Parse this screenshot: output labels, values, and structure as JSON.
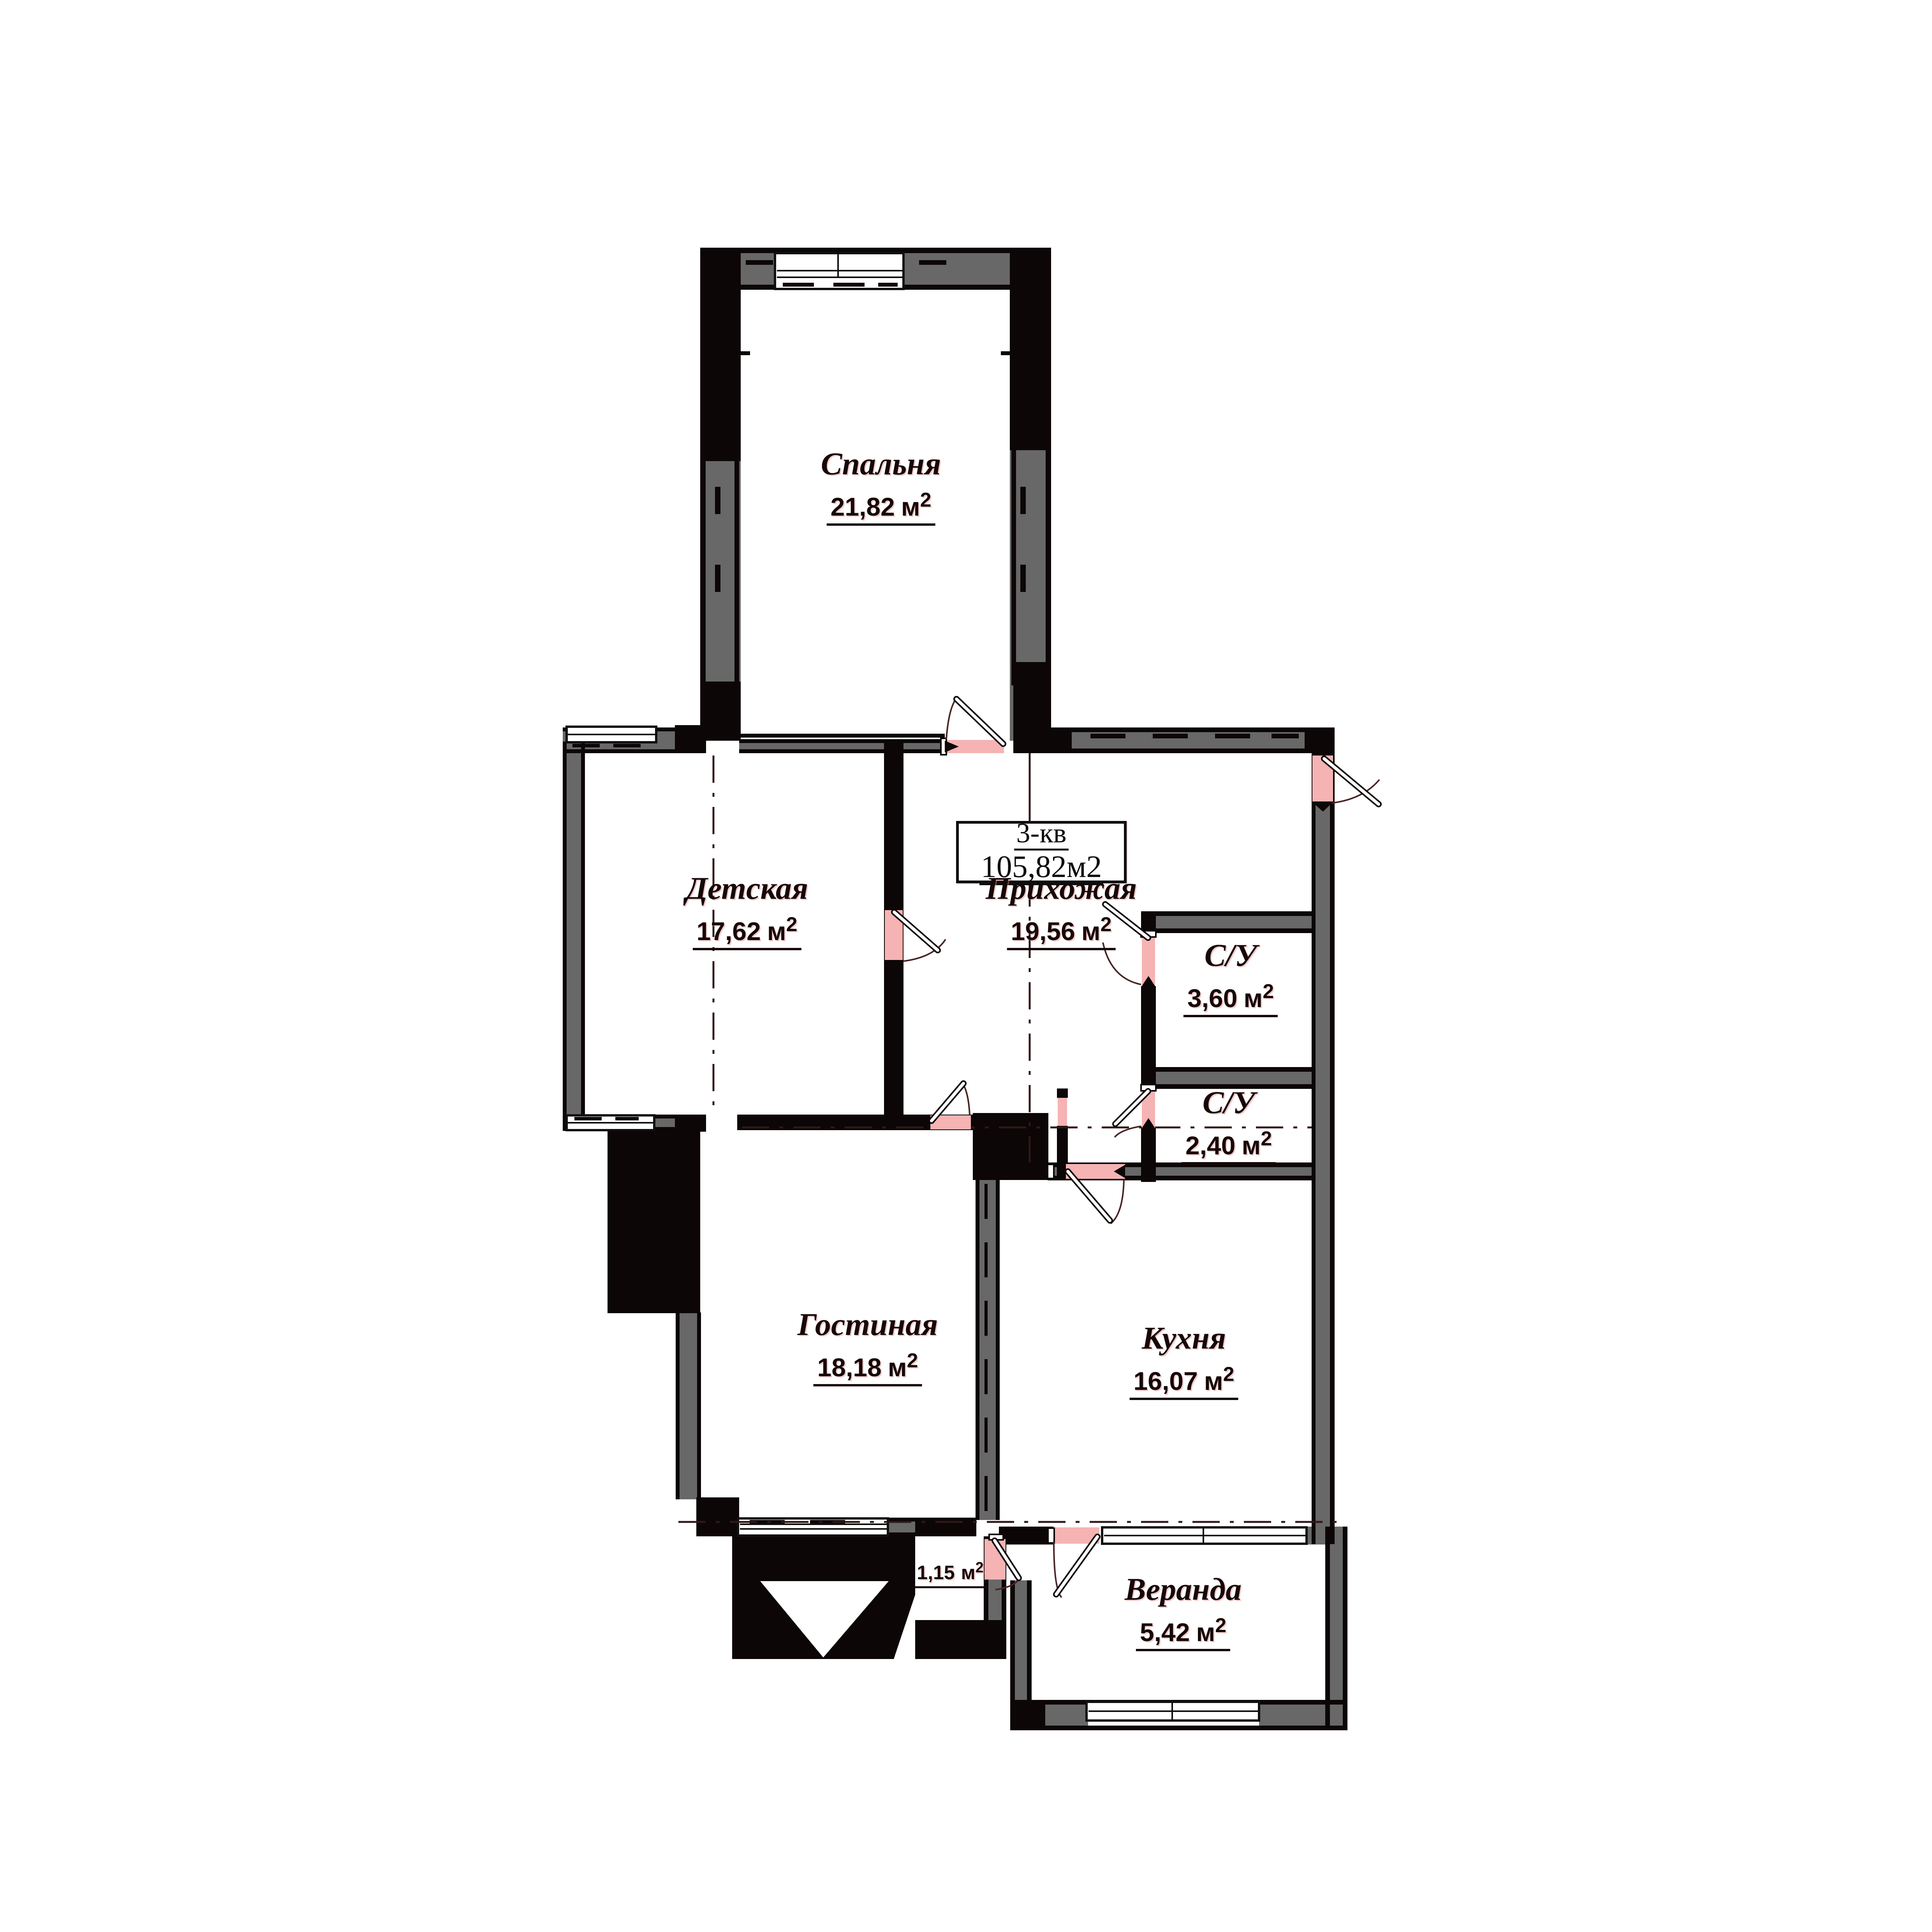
{
  "title_box": {
    "apartment": "3-кв",
    "total_area": "105,82м2"
  },
  "rooms": {
    "bedroom": {
      "name": "Спальня",
      "area": "21,82",
      "unit": "м",
      "sup": "2"
    },
    "kids": {
      "name": "Детская",
      "area": "17,62",
      "unit": "м",
      "sup": "2"
    },
    "hallway": {
      "name": "Прихожая",
      "area": "19,56",
      "unit": "м",
      "sup": "2"
    },
    "bathroom1": {
      "name": "С/У",
      "area": "3,60",
      "unit": "м",
      "sup": "2"
    },
    "bathroom2": {
      "name": "С/У",
      "area": "2,40",
      "unit": "м",
      "sup": "2"
    },
    "living": {
      "name": "Гостиная",
      "area": "18,18",
      "unit": "м",
      "sup": "2"
    },
    "kitchen": {
      "name": "Кухня",
      "area": "16,07",
      "unit": "м",
      "sup": "2"
    },
    "storage": {
      "area": "1,15",
      "unit": "м",
      "sup": "2"
    },
    "veranda": {
      "name": "Веранда",
      "area": "5,42",
      "unit": "м",
      "sup": "2"
    }
  },
  "colors": {
    "wall_gray": "#686868",
    "wall_black": "#0c0606",
    "door_opening_pink": "#f6b3b3",
    "axis_line": "#301818",
    "text": "#170808",
    "background": "#ffffff"
  }
}
